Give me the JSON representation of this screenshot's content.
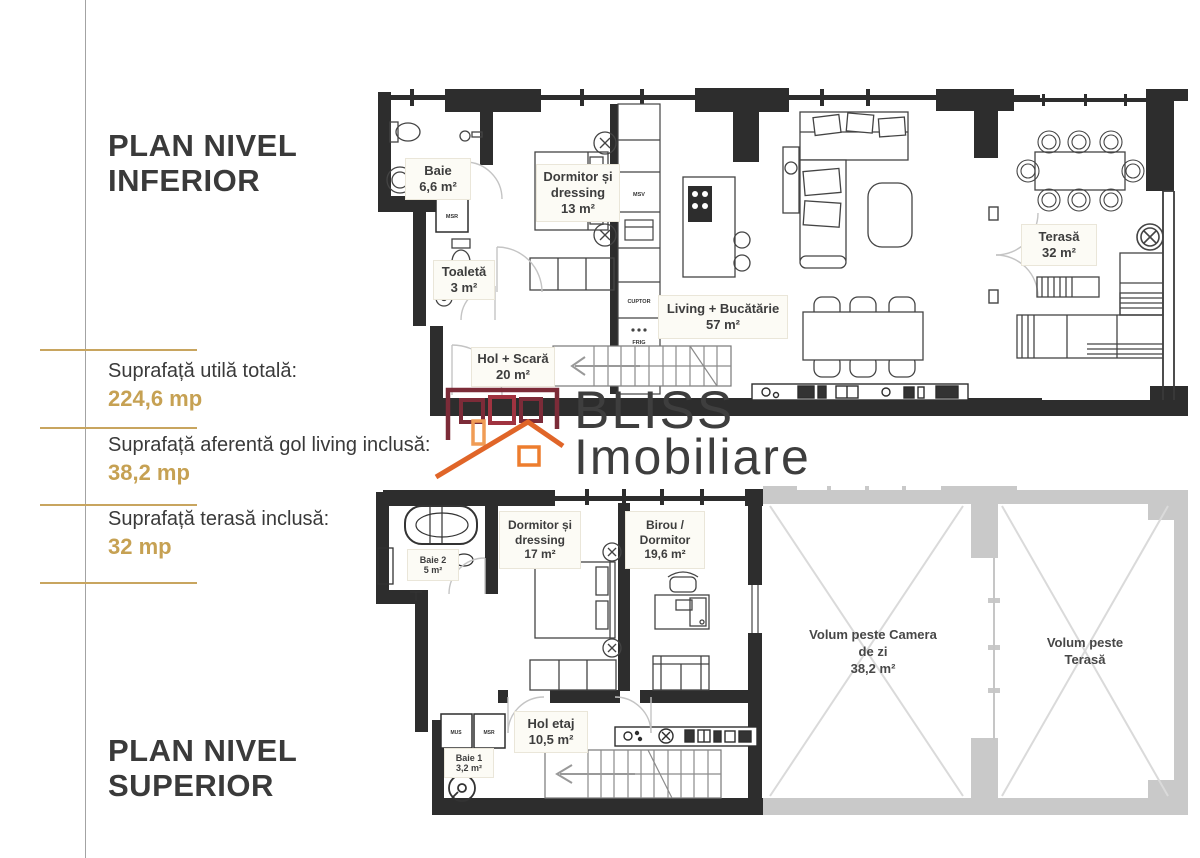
{
  "left_panel": {
    "title_upper": "PLAN NIVEL INFERIOR",
    "title_lower": "PLAN NIVEL SUPERIOR",
    "stats": [
      {
        "label": "Suprafață utilă totală:",
        "value": "224,6 mp"
      },
      {
        "label": "Suprafață aferentă gol living inclusă:",
        "value": "38,2 mp"
      },
      {
        "label": "Suprafață terasă inclusă:",
        "value": "32 mp"
      }
    ]
  },
  "logo": {
    "name_top": "BLISS",
    "name_bottom": "Imobiliare"
  },
  "upper_plan": {
    "rooms": {
      "baie": {
        "name": "Baie",
        "area": "6,6 m²"
      },
      "dormitor": {
        "name": "Dormitor și dressing",
        "area": "13 m²"
      },
      "toaleta": {
        "name": "Toaletă",
        "area": "3 m²"
      },
      "living": {
        "name": "Living + Bucătărie",
        "area": "57 m²"
      },
      "hol": {
        "name": "Hol + Scară",
        "area": "20 m²"
      },
      "terasa": {
        "name": "Terasă",
        "area": "32 m²"
      }
    },
    "appliances": {
      "msr": "MSR",
      "msv": "MSV",
      "cuptor": "CUPTOR",
      "frig": "FRIG"
    }
  },
  "lower_plan": {
    "rooms": {
      "baie2": {
        "name": "Baie 2",
        "area": "5 m²"
      },
      "dormitor": {
        "name": "Dormitor și dressing",
        "area": "17 m²"
      },
      "birou": {
        "name": "Birou / Dormitor",
        "area": "19,6 m²"
      },
      "hol_etaj": {
        "name": "Hol etaj",
        "area": "10,5 m²"
      },
      "baie1": {
        "name": "Baie 1",
        "area": "3,2 m²"
      },
      "volum_living": {
        "name": "Volum peste Camera de zi",
        "area": "38,2 m²"
      },
      "volum_terasa": {
        "name": "Volum peste Terasă",
        "area": ""
      }
    },
    "appliances": {
      "mus": "MUS",
      "msr": "MSR"
    }
  },
  "colors": {
    "wall": "#2d2d2d",
    "gray_wall": "#c9c9c9",
    "gold": "#c6a153",
    "text_dark": "#3b3b3b",
    "logo_maroon": "#7c2b38",
    "logo_orange": "#e06528",
    "logo_light_orange": "#f09c55"
  }
}
